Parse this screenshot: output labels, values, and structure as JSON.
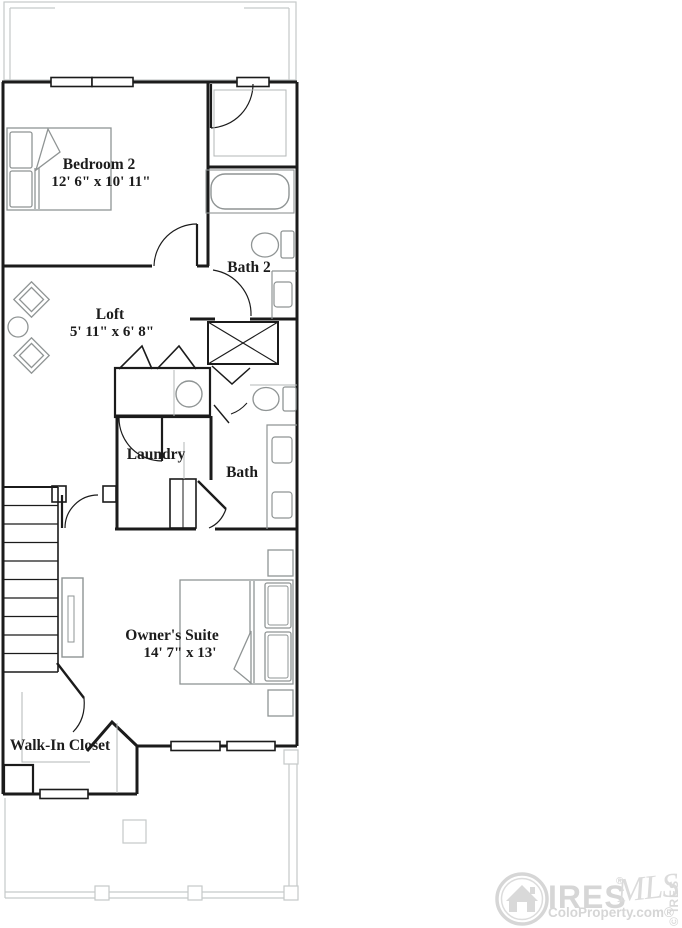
{
  "floorplan": {
    "rooms": {
      "bedroom2": {
        "name": "Bedroom 2",
        "dims": "12' 6\" x 10' 11\""
      },
      "bath2": {
        "name": "Bath 2"
      },
      "loft": {
        "name": "Loft",
        "dims": "5' 11\" x 6' 8\""
      },
      "laundry": {
        "name": "Laundry"
      },
      "bath": {
        "name": "Bath"
      },
      "owners_suite": {
        "name": "Owner's Suite",
        "dims": "14' 7\" x 13'"
      },
      "walk_in_closet": {
        "name": "Walk-In Closet"
      }
    }
  },
  "watermark": {
    "brand": "IRES",
    "brand_reg": "®",
    "mls_script": "MLS",
    "site": "ColoProperty.com®",
    "side_text": "© IRES"
  },
  "colors": {
    "wall": "#1b1b1b",
    "fixture": "#8f9494",
    "deck": "#c5c9c9",
    "watermark": "#d6d6d6",
    "background": "#ffffff"
  }
}
